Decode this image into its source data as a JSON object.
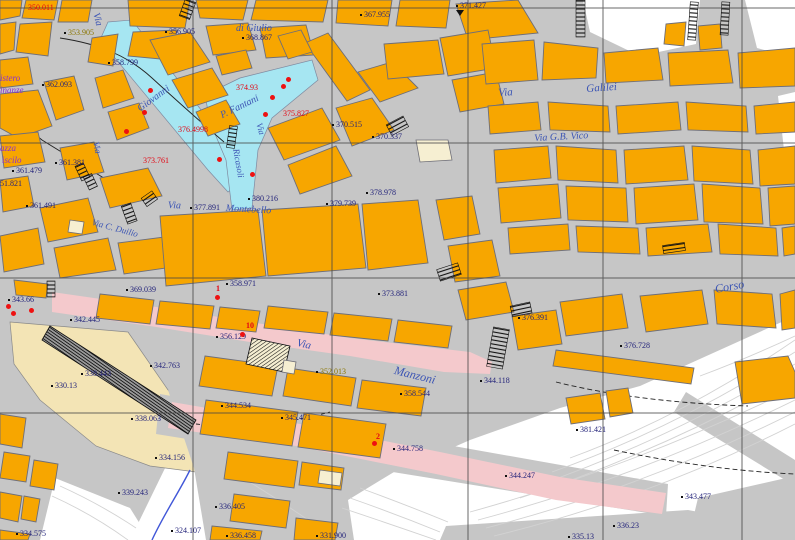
{
  "map": {
    "colors": {
      "navy": "#23237a",
      "street": "#3c55b4",
      "purple": "#8a2fd0",
      "olive": "#8a7500",
      "red": "#e30613",
      "building_orange": "#f7a600",
      "canal_blue": "#a6e6f2",
      "road_pink": "#f4c9cc",
      "terrain_beige": "#f3e4b5",
      "background_gray": "#c6c6c6"
    },
    "street_labels": [
      {
        "text": "Via",
        "x": 100,
        "y": 12,
        "rot": 75,
        "size": 10
      },
      {
        "text": "Giovanni",
        "x": 136,
        "y": 106,
        "rot": -36,
        "size": 10
      },
      {
        "text": "Via",
        "x": 100,
        "y": 141,
        "rot": 78,
        "size": 9
      },
      {
        "text": "P. Fantani",
        "x": 219,
        "y": 112,
        "rot": -26,
        "size": 10
      },
      {
        "text": "Via",
        "x": 263,
        "y": 122,
        "rot": 74,
        "size": 9
      },
      {
        "text": "Ricasoli",
        "x": 240,
        "y": 148,
        "rot": 80,
        "size": 9
      },
      {
        "text": "di Giulio",
        "x": 236,
        "y": 24,
        "rot": 0,
        "size": 10
      },
      {
        "text": "Via C. Duilio",
        "x": 93,
        "y": 218,
        "rot": 15,
        "size": 9
      },
      {
        "text": "Via",
        "x": 168,
        "y": 201,
        "rot": 2,
        "size": 10
      },
      {
        "text": "Montebello",
        "x": 226,
        "y": 204,
        "rot": 3,
        "size": 10
      },
      {
        "text": "Via",
        "x": 498,
        "y": 88,
        "rot": -3,
        "size": 11
      },
      {
        "text": "Galilei",
        "x": 586,
        "y": 84,
        "rot": -4,
        "size": 11
      },
      {
        "text": "Via  G.B.  Vico",
        "x": 534,
        "y": 134,
        "rot": -3,
        "size": 10
      },
      {
        "text": "Corso",
        "x": 714,
        "y": 283,
        "rot": -10,
        "size": 12
      },
      {
        "text": "Via",
        "x": 298,
        "y": 338,
        "rot": 13,
        "size": 11
      },
      {
        "text": "Manzoni",
        "x": 396,
        "y": 364,
        "rot": 14,
        "size": 12
      }
    ],
    "district_labels": [
      {
        "text": "istero",
        "x": 0,
        "y": 74
      },
      {
        "text": "inanze",
        "x": 0,
        "y": 86
      },
      {
        "text": "azza",
        "x": 0,
        "y": 144
      },
      {
        "text": "iscilo",
        "x": 2,
        "y": 156
      }
    ],
    "elevation_labels": [
      {
        "text": "353.905",
        "x": 64,
        "y": 29,
        "c": "olive"
      },
      {
        "text": "356.905",
        "x": 165,
        "y": 28
      },
      {
        "text": "367.955",
        "x": 360,
        "y": 11
      },
      {
        "text": "371.427",
        "x": 456,
        "y": 2
      },
      {
        "text": "368.867",
        "x": 242,
        "y": 34
      },
      {
        "text": "358.799",
        "x": 108,
        "y": 59
      },
      {
        "text": "362.093",
        "x": 42,
        "y": 81
      },
      {
        "text": "361.381",
        "x": 55,
        "y": 159
      },
      {
        "text": "361.479",
        "x": 12,
        "y": 167
      },
      {
        "text": "351.821",
        "x": -8,
        "y": 180
      },
      {
        "text": "361.491",
        "x": 26,
        "y": 202
      },
      {
        "text": "370.515",
        "x": 332,
        "y": 121
      },
      {
        "text": "370.337",
        "x": 372,
        "y": 133
      },
      {
        "text": "380.216",
        "x": 248,
        "y": 195
      },
      {
        "text": "377.891",
        "x": 190,
        "y": 204
      },
      {
        "text": "379.739",
        "x": 326,
        "y": 200
      },
      {
        "text": "378.978",
        "x": 366,
        "y": 189
      },
      {
        "text": "373.881",
        "x": 378,
        "y": 290
      },
      {
        "text": "376.391",
        "x": 518,
        "y": 314
      },
      {
        "text": "376.728",
        "x": 620,
        "y": 342
      },
      {
        "text": "358.971",
        "x": 226,
        "y": 280
      },
      {
        "text": "369.039",
        "x": 126,
        "y": 286
      },
      {
        "text": "343.66",
        "x": 8,
        "y": 296
      },
      {
        "text": "342.445",
        "x": 70,
        "y": 316
      },
      {
        "text": "356.129",
        "x": 216,
        "y": 333
      },
      {
        "text": "352.013",
        "x": 316,
        "y": 368,
        "c": "olive"
      },
      {
        "text": "358.544",
        "x": 400,
        "y": 390
      },
      {
        "text": "344.118",
        "x": 480,
        "y": 377
      },
      {
        "text": "342.763",
        "x": 150,
        "y": 362
      },
      {
        "text": "338.443",
        "x": 81,
        "y": 370
      },
      {
        "text": "330.13",
        "x": 51,
        "y": 382
      },
      {
        "text": "338.063",
        "x": 131,
        "y": 415
      },
      {
        "text": "334.156",
        "x": 155,
        "y": 454
      },
      {
        "text": "339.243",
        "x": 118,
        "y": 489
      },
      {
        "text": "324.107",
        "x": 171,
        "y": 527
      },
      {
        "text": "334.575",
        "x": 16,
        "y": 530
      },
      {
        "text": "336.405",
        "x": 215,
        "y": 503
      },
      {
        "text": "336.458",
        "x": 226,
        "y": 532
      },
      {
        "text": "331.900",
        "x": 316,
        "y": 532
      },
      {
        "text": "344.534",
        "x": 221,
        "y": 402
      },
      {
        "text": "345.471",
        "x": 281,
        "y": 414
      },
      {
        "text": "344.758",
        "x": 393,
        "y": 445
      },
      {
        "text": "344.247",
        "x": 505,
        "y": 472
      },
      {
        "text": "343.477",
        "x": 681,
        "y": 493
      },
      {
        "text": "336.23",
        "x": 613,
        "y": 522
      },
      {
        "text": "335.13",
        "x": 568,
        "y": 533
      },
      {
        "text": "381.421",
        "x": 576,
        "y": 426
      }
    ],
    "red_labels": [
      {
        "text": "350.011",
        "x": 28,
        "y": 4
      },
      {
        "text": "374.93",
        "x": 236,
        "y": 84
      },
      {
        "text": "376.4998",
        "x": 178,
        "y": 126
      },
      {
        "text": "373.761",
        "x": 143,
        "y": 157
      },
      {
        "text": "375.827",
        "x": 283,
        "y": 110
      },
      {
        "text": "10",
        "x": 246,
        "y": 322,
        "b": 1
      },
      {
        "text": "1",
        "x": 216,
        "y": 285,
        "b": 1
      },
      {
        "text": "2",
        "x": 376,
        "y": 433,
        "b": 1
      }
    ],
    "point_markers": [
      {
        "x": 150,
        "y": 90
      },
      {
        "x": 144,
        "y": 112
      },
      {
        "x": 126,
        "y": 131
      },
      {
        "x": 283,
        "y": 86
      },
      {
        "x": 272,
        "y": 97
      },
      {
        "x": 288,
        "y": 79
      },
      {
        "x": 265,
        "y": 114
      },
      {
        "x": 219,
        "y": 159
      },
      {
        "x": 252,
        "y": 174
      },
      {
        "x": 8,
        "y": 306
      },
      {
        "x": 13,
        "y": 313
      },
      {
        "x": 31,
        "y": 310
      },
      {
        "x": 217,
        "y": 297
      },
      {
        "x": 242,
        "y": 334
      },
      {
        "x": 374,
        "y": 443
      }
    ]
  }
}
